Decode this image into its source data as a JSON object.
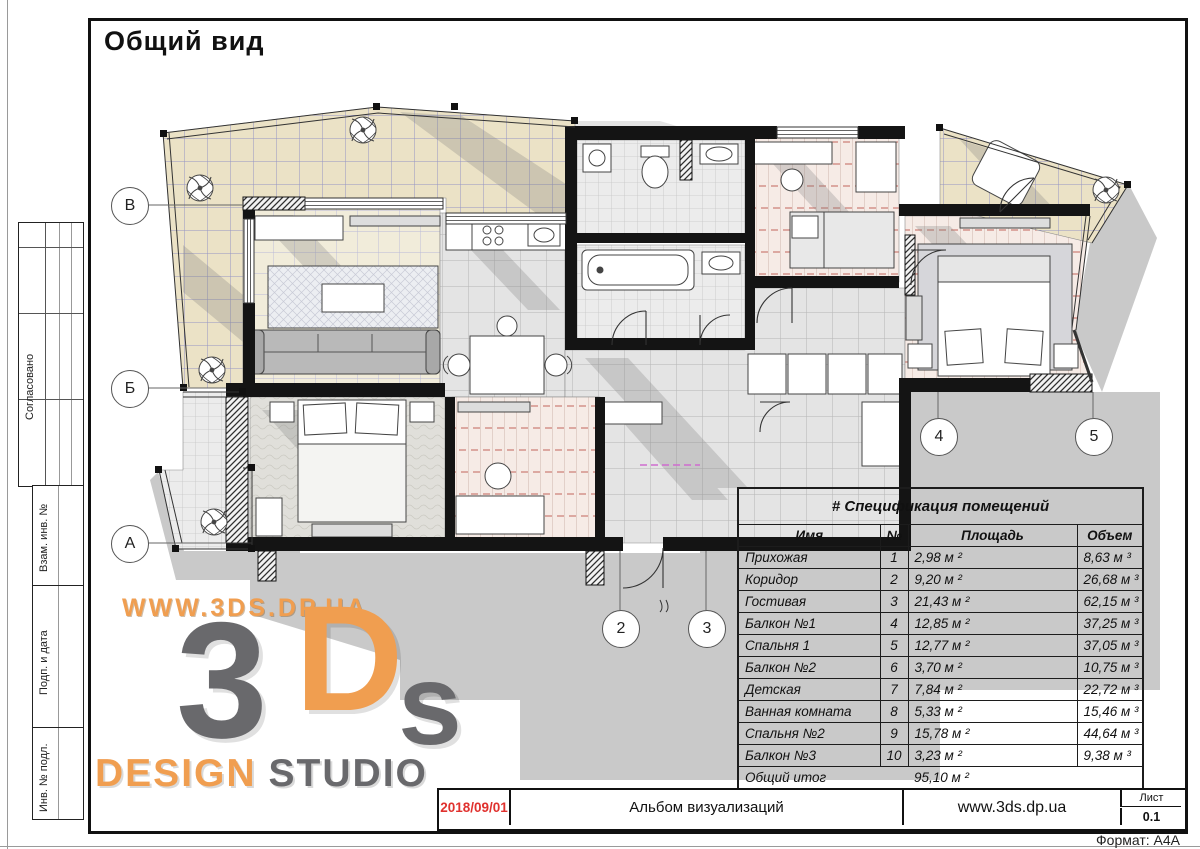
{
  "page": {
    "title": "Общий вид",
    "format": "Формат: А4А"
  },
  "sidebar": {
    "labels": [
      "Согласовано",
      "Взам. инв. №",
      "Подп. и дата",
      "Инв. № подл."
    ]
  },
  "watermark": {
    "url_text": "WWW.3DS.DP.UA",
    "logo_3": "3",
    "logo_d": "D",
    "logo_s": "s",
    "design": "DESIGN",
    "studio": "STUDIO",
    "orange": "#f09e50",
    "gray": "#69696c"
  },
  "plan": {
    "row_markers": [
      {
        "label": "В"
      },
      {
        "label": "Б"
      },
      {
        "label": "А"
      }
    ],
    "col_markers": [
      {
        "label": "2"
      },
      {
        "label": "3"
      },
      {
        "label": "4"
      },
      {
        "label": "5"
      }
    ]
  },
  "spec_table": {
    "title": "# Спецификация помещений",
    "columns": {
      "name": "Имя",
      "num": "№",
      "area": "Площадь",
      "volume": "Объем"
    },
    "rows": [
      {
        "name": "Прихожая",
        "num": "1",
        "area": "2,98 м ²",
        "volume": "8,63 м ³"
      },
      {
        "name": "Коридор",
        "num": "2",
        "area": "9,20 м ²",
        "volume": "26,68 м ³"
      },
      {
        "name": "Гостивая",
        "num": "3",
        "area": "21,43 м ²",
        "volume": "62,15 м ³"
      },
      {
        "name": "Балкон №1",
        "num": "4",
        "area": "12,85 м ²",
        "volume": "37,25 м ³"
      },
      {
        "name": "Спальня 1",
        "num": "5",
        "area": "12,77 м ²",
        "volume": "37,05 м ³"
      },
      {
        "name": "Балкон №2",
        "num": "6",
        "area": "3,70 м ²",
        "volume": "10,75 м ³"
      },
      {
        "name": "Детская",
        "num": "7",
        "area": "7,84 м ²",
        "volume": "22,72 м ³"
      },
      {
        "name": "Ванная комната",
        "num": "8",
        "area": "5,33 м ²",
        "volume": "15,46 м ³"
      },
      {
        "name": "Спальня №2",
        "num": "9",
        "area": "15,78 м ²",
        "volume": "44,64 м ³"
      },
      {
        "name": "Балкон №3",
        "num": "10",
        "area": "3,23 м ²",
        "volume": "9,38 м ³"
      }
    ],
    "total": {
      "name": "Общий итог",
      "area": "95,10 м ²"
    }
  },
  "title_block": {
    "date": "2018/09/01",
    "album": "Альбом визуализаций",
    "site": "www.3ds.dp.ua",
    "sheet_label": "Лист",
    "sheet_number": "0.1",
    "date_color": "#e0312e"
  }
}
